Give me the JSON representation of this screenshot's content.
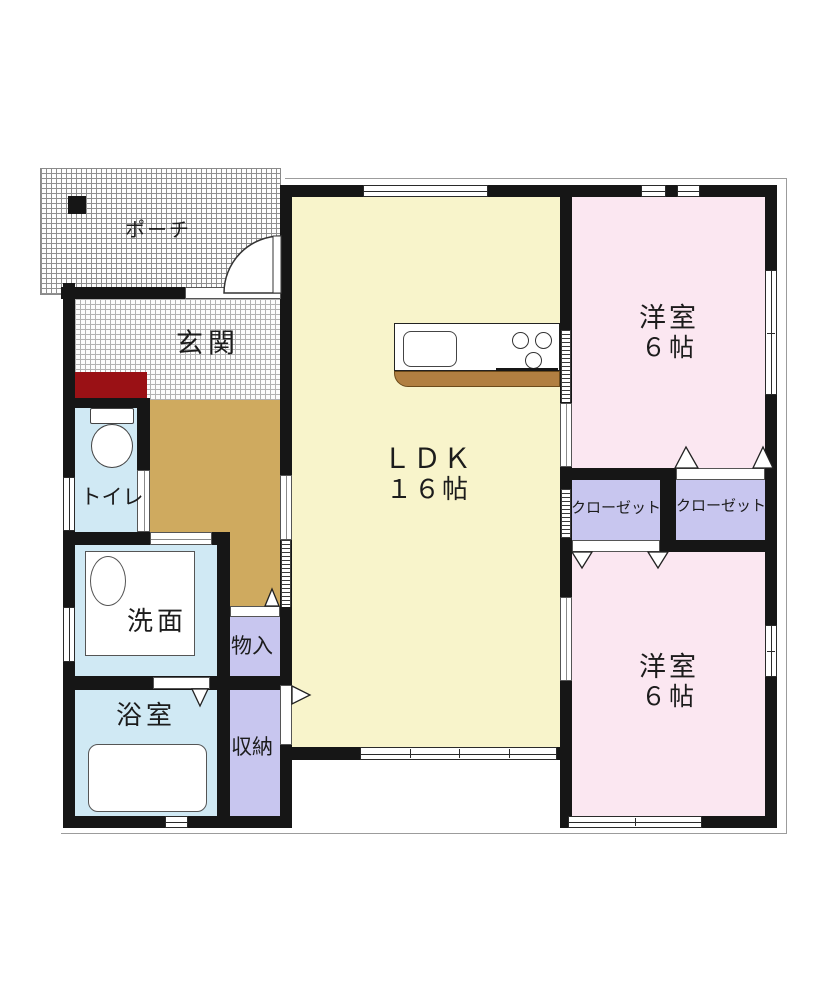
{
  "colors": {
    "wall": "#161616",
    "ldk": "#f8f4cb",
    "bedroom": "#fbe7f1",
    "storage": "#c8c6ef",
    "water": "#d0e9f4",
    "hall": "#cfaa5f",
    "shoe_cabinet": "#9a1115",
    "wood": "#b17f41",
    "tile_line": "#8f8f8f",
    "text": "#1c1c1c"
  },
  "rooms": {
    "porch": {
      "label": "ポーチ"
    },
    "genkan": {
      "label": "玄関"
    },
    "toilet": {
      "label": "トイレ"
    },
    "washroom": {
      "label": "洗面"
    },
    "bathroom": {
      "label": "浴室"
    },
    "storage_small": {
      "label": "物入"
    },
    "storage_tall": {
      "label": "収納"
    },
    "ldk": {
      "label": "ＬＤＫ",
      "size": "１６帖"
    },
    "bedroom_top": {
      "label": "洋室",
      "size": "６帖"
    },
    "bedroom_bottom": {
      "label": "洋室",
      "size": "６帖"
    },
    "closet_left": {
      "label": "クローゼット"
    },
    "closet_right": {
      "label": "クローゼット"
    }
  }
}
